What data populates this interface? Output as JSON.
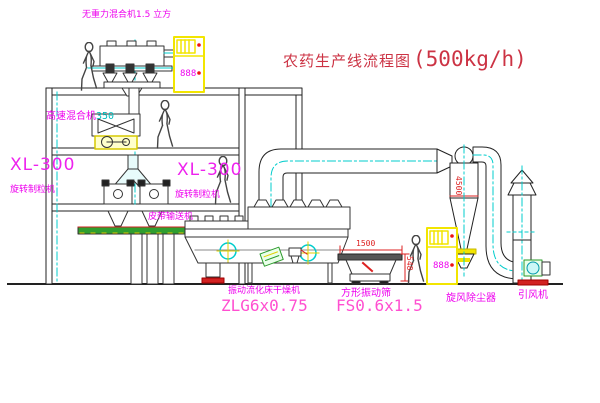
{
  "meta": {
    "canvas_width": 600,
    "canvas_height": 403,
    "background": "#ffffff"
  },
  "title": {
    "name": "农药生产线流程图",
    "capacity": "(500kg/h)",
    "color": "#cc3344"
  },
  "equipment_labels": {
    "gravity_mixer": {
      "text": "无重力混合机1.5 立方"
    },
    "high_speed_mixer": {
      "text": "高速混合机",
      "capacity": "350"
    },
    "granulator_left": {
      "model": "XL-300",
      "name": "旋转制粒机"
    },
    "granulator_center": {
      "model": "XL-300",
      "name": "旋转制粒机"
    },
    "belt_conveyor": {
      "text": "皮带输送机"
    },
    "fluid_bed_dryer": {
      "name": "振动流化床干燥机",
      "model": "ZLG6x0.75"
    },
    "square_sieve": {
      "name": "方形振动筛",
      "model": "FS0.6x1.5"
    },
    "cyclone": {
      "name": "旋风除尘器"
    },
    "induced_draft_fan": {
      "name": "引风机"
    }
  },
  "dimensions": {
    "sieve_length": "1500",
    "sieve_height": "548",
    "cyclone_height": "4500"
  },
  "control_cabinet": {
    "display": "888"
  },
  "colors": {
    "label_magenta": "#ee00ee",
    "model_pink": "#ff4fd0",
    "title_red": "#cc3344",
    "dimension_red": "#dd2222",
    "line_dark": "#222222",
    "centerline_cyan": "#00cccc",
    "highlight_yellow": "#f2e500"
  }
}
